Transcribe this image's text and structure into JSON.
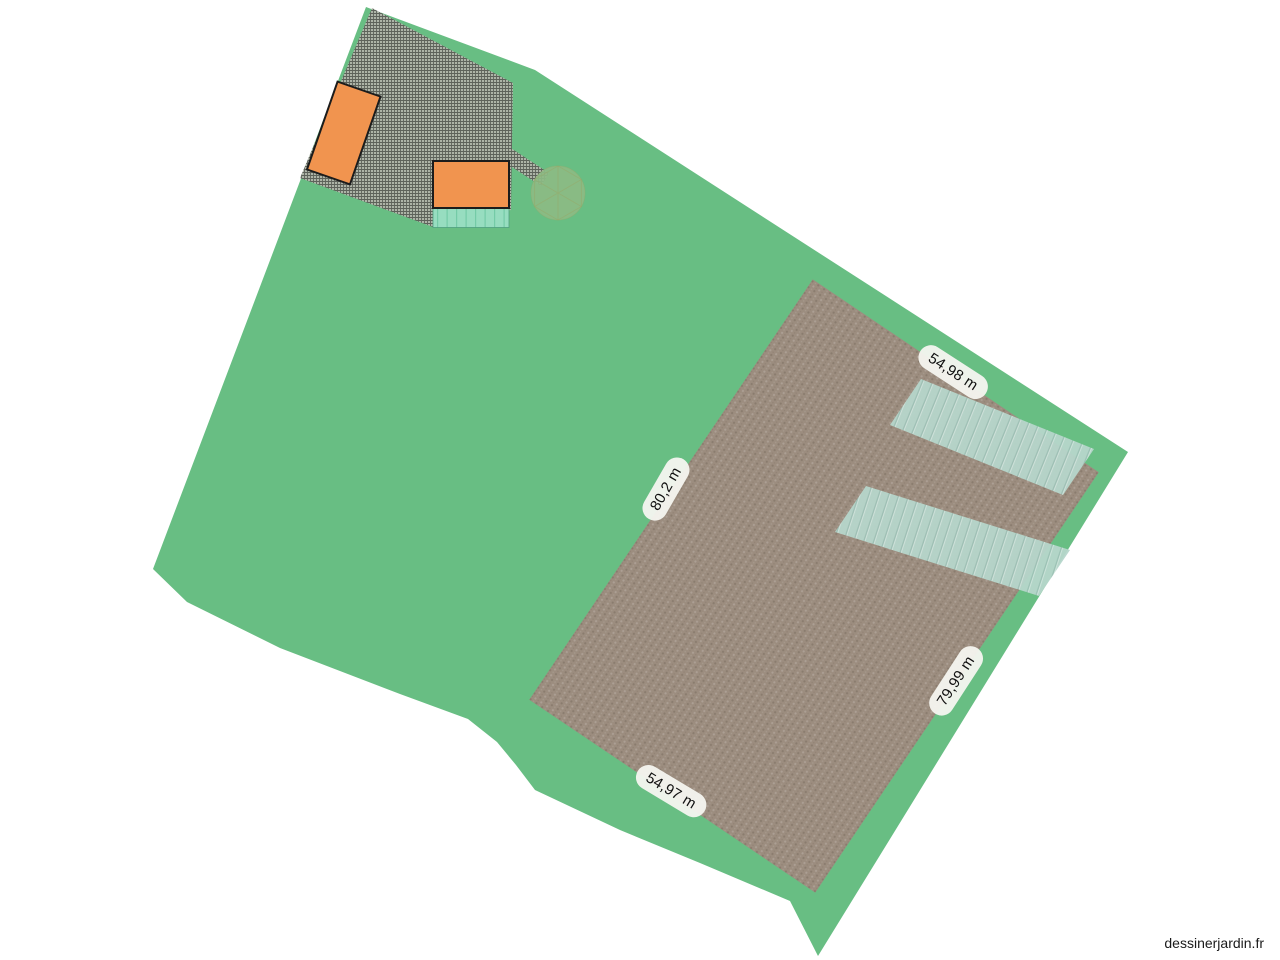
{
  "watermark": {
    "text": "dessinerjardin.fr"
  },
  "colors": {
    "background": "#ffffff",
    "grass": "#68be83",
    "gravel_base": "#adb4a7",
    "field_base": "#9c8d7f",
    "crop_strip_base": "#b6d6cb",
    "terrace_base": "#97ddc0",
    "terrace_stripe": "#74cba7",
    "building_fill": "#f1944f",
    "building_border": "#1c1c1c",
    "tree_fill": "#8cbb84",
    "tree_lines": "#9aa763",
    "label_bg": "#f4f4ef",
    "label_text": "#111111"
  },
  "dimension_labels": [
    {
      "id": "north-east-edge",
      "text": "54,98 m"
    },
    {
      "id": "north-west-edge",
      "text": "80,2 m"
    },
    {
      "id": "south-east-edge",
      "text": "79,99 m"
    },
    {
      "id": "south-west-edge",
      "text": "54,97 m"
    }
  ]
}
